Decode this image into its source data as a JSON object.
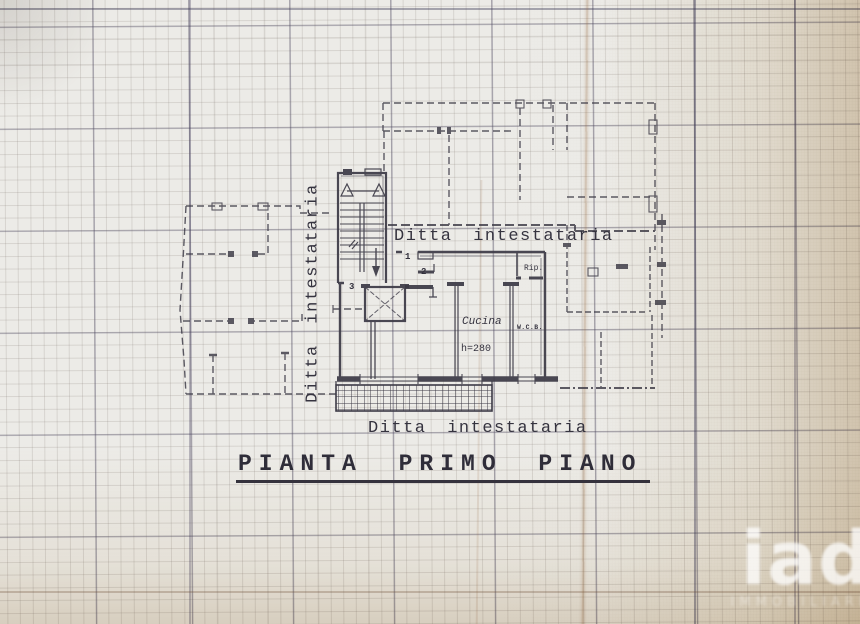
{
  "document": {
    "plan_title": "PIANTA PRIMO PIANO",
    "owner_labels": {
      "top": "Ditta intestataria",
      "left": "Ditta intestataria",
      "bottom": "Ditta intestataria"
    }
  },
  "plan": {
    "rooms": {
      "kitchen": "Cucina",
      "kitchen_height": "h=280",
      "wc": "W.C.B.",
      "storage": "Rip."
    },
    "door_numbers": {
      "one": "1",
      "two": "2",
      "three": "3"
    }
  },
  "watermark": {
    "brand": "iad",
    "subtext": "immobiliare"
  },
  "colors": {
    "paper": "#ecebe7",
    "ink": "#3c3a46",
    "grid_major": "#4e4a66",
    "grid_minor": "#80766e",
    "sepia_edge": "#c4a878"
  }
}
